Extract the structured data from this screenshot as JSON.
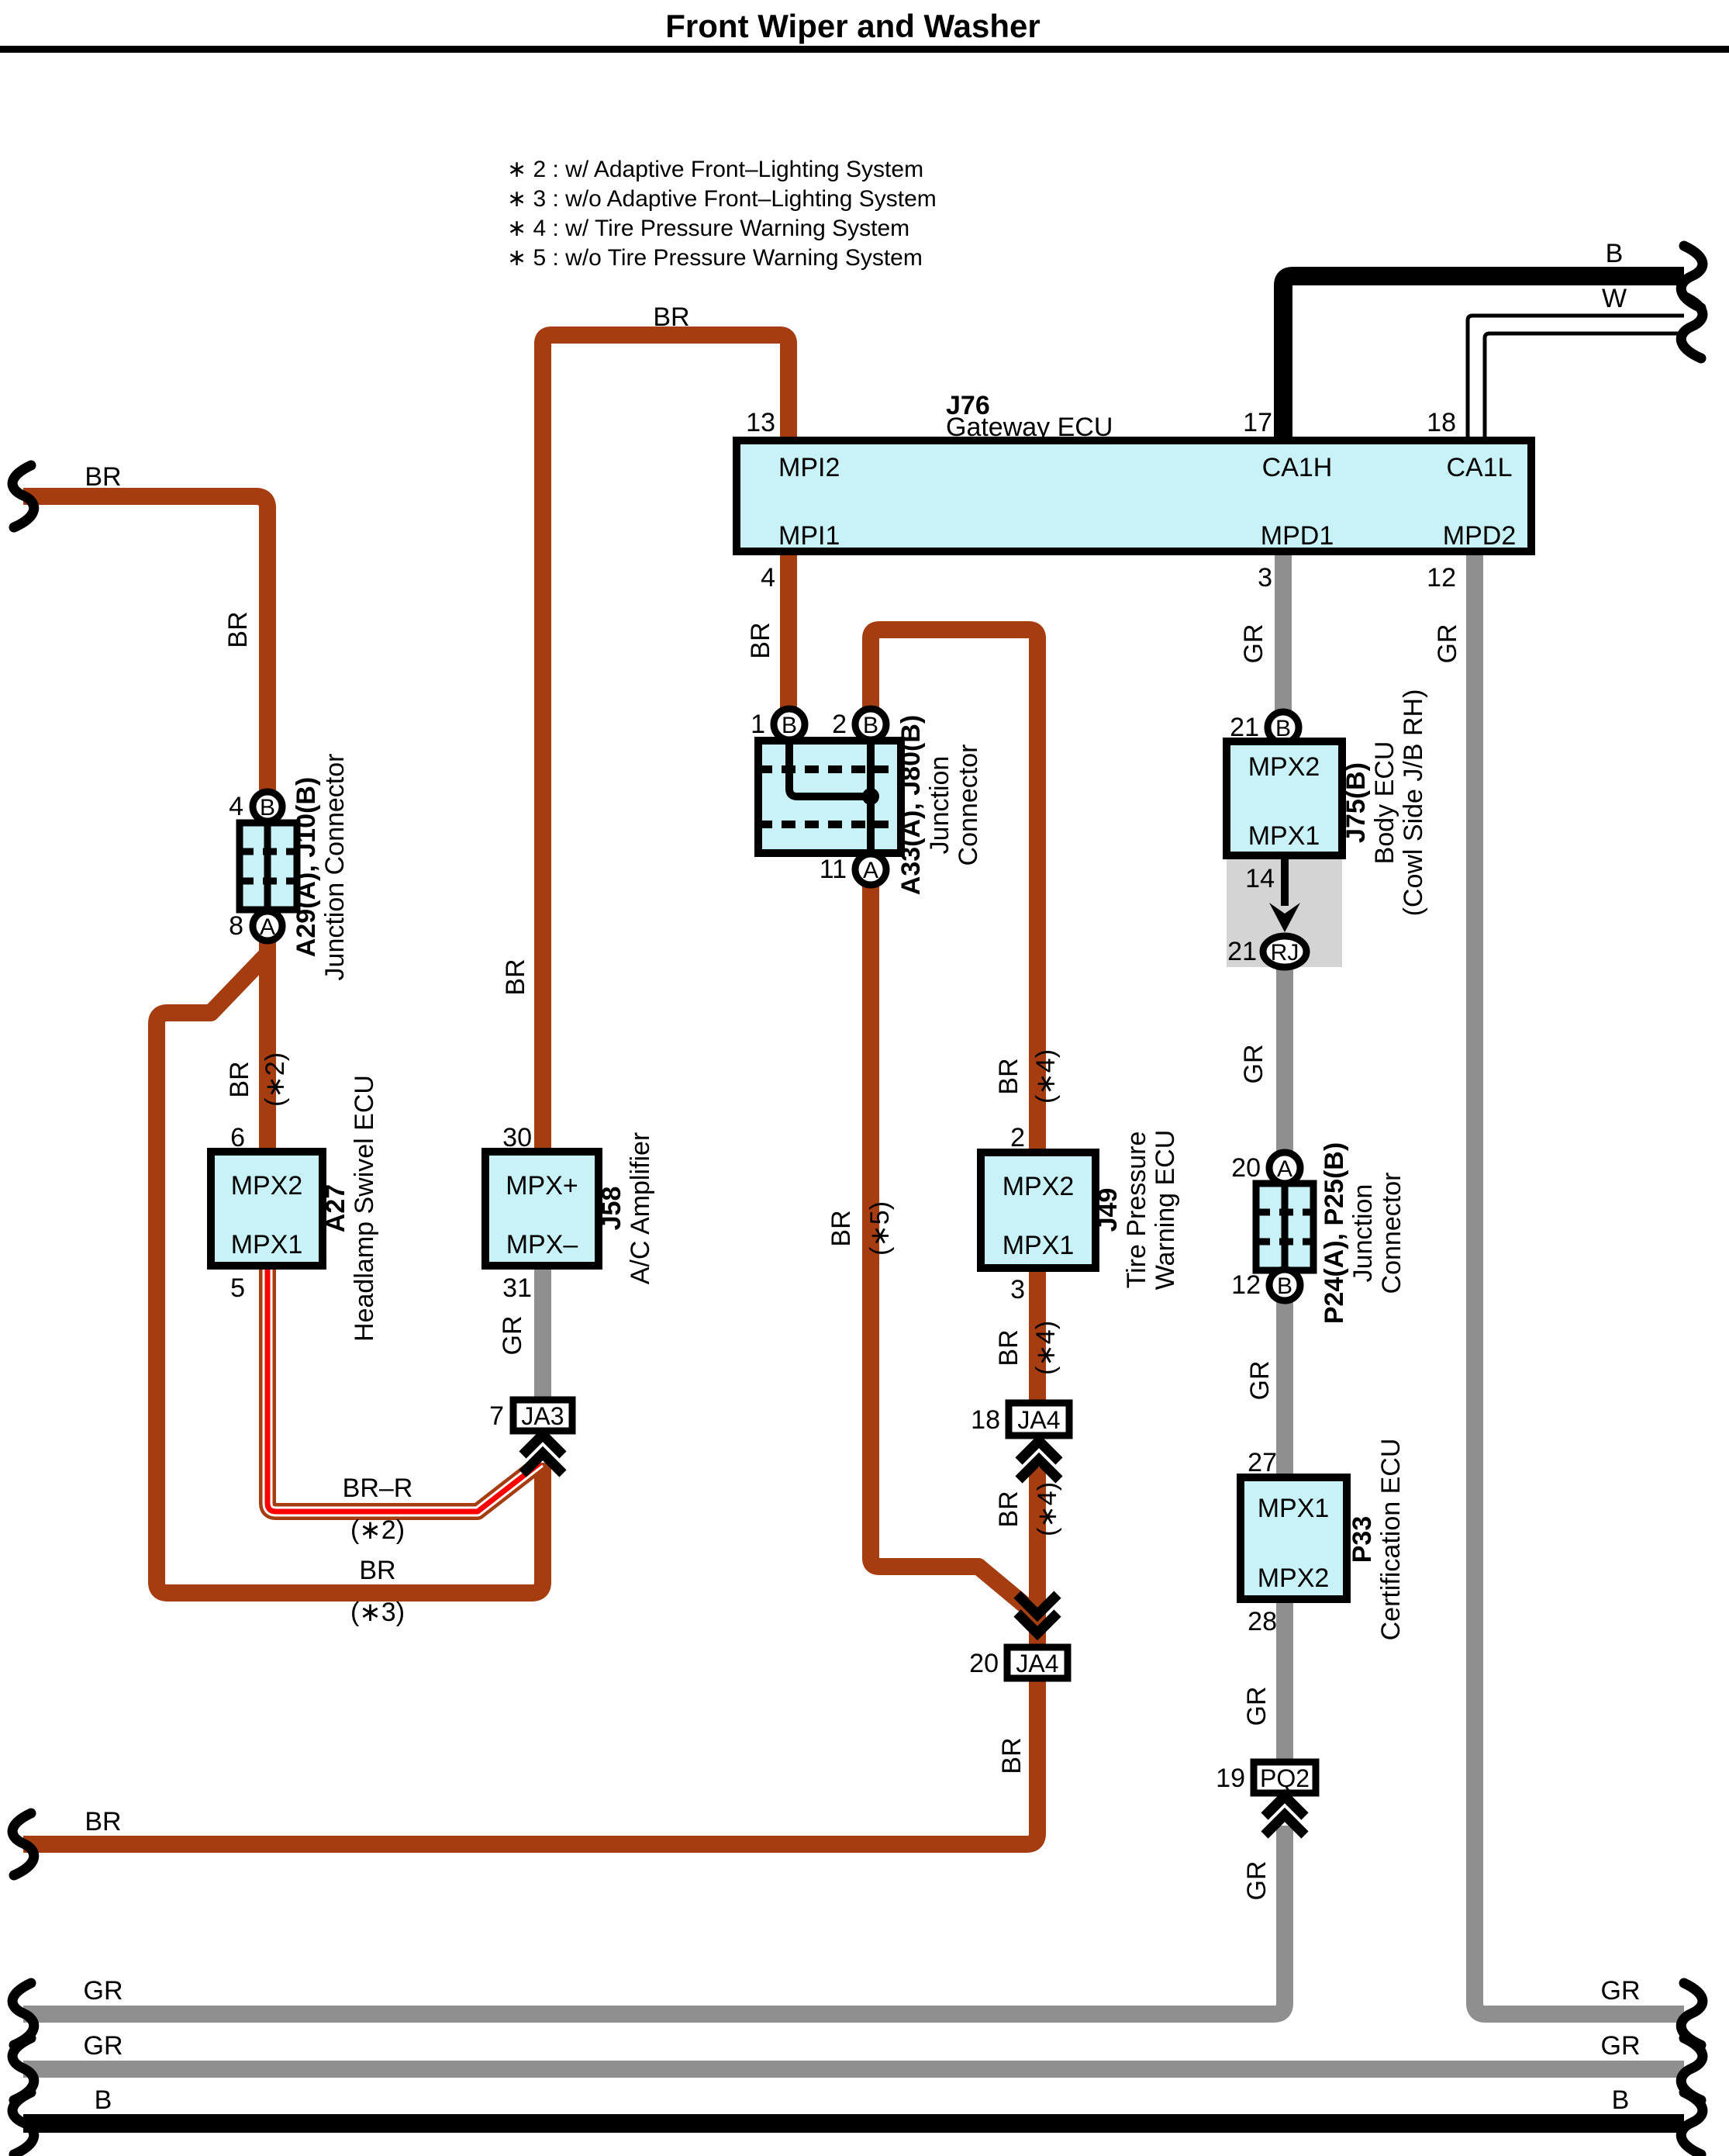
{
  "title": "Front Wiper and Washer",
  "notes": {
    "n2": "∗ 2 : w/ Adaptive Front–Lighting System",
    "n3": "∗ 3 : w/o Adaptive Front–Lighting System",
    "n4": "∗ 4 : w/ Tire Pressure Warning System",
    "n5": "∗ 5 : w/o Tire Pressure Warning System"
  },
  "colors": {
    "wire_brown": "#A63D11",
    "wire_gray": "#8F8F8F",
    "wire_black": "#000000",
    "wire_red_stripe": "#FF0000",
    "component_fill": "#C9F2F8",
    "shade_fill": "#D4D4D4"
  },
  "wire_labels": {
    "br": "BR",
    "gr": "GR",
    "b": "B",
    "w": "W",
    "br_r": "BR–R",
    "s2": "(∗2)",
    "s3": "(∗3)",
    "s4": "(∗4)",
    "s5": "(∗5)"
  },
  "j76": {
    "name": "J76",
    "desc": "Gateway ECU",
    "mpi2": "MPI2",
    "pin_mpi2": "13",
    "mpi1": "MPI1",
    "pin_mpi1": "4",
    "ca1h": "CA1H",
    "pin_ca1h": "17",
    "mpd1": "MPD1",
    "pin_mpd1": "3",
    "ca1l": "CA1L",
    "pin_ca1l": "18",
    "mpd2": "MPD2",
    "pin_mpd2": "12"
  },
  "a29": {
    "name": "A29(A), J10(B)",
    "desc": "Junction Connector",
    "pin_top": "4",
    "top": "B",
    "pin_bottom": "8",
    "bottom": "A"
  },
  "a33": {
    "name": "A33(A), J80(B)",
    "desc1": "Junction",
    "desc2": "Connector",
    "pin1": "1",
    "l1": "B",
    "pin2": "2",
    "l2": "B",
    "pin11": "11",
    "l11": "A"
  },
  "a27": {
    "name": "A27",
    "desc": "Headlamp Swivel ECU",
    "top": "MPX2",
    "bottom": "MPX1",
    "pin_top": "6",
    "pin_bottom": "5"
  },
  "j58": {
    "name": "J58",
    "desc": "A/C Amplifier",
    "top": "MPX+",
    "bottom": "MPX–",
    "pin_top": "30",
    "pin_bottom": "31"
  },
  "j49": {
    "name": "J49",
    "desc1": "Tire Pressure",
    "desc2": "Warning ECU",
    "top": "MPX2",
    "bottom": "MPX1",
    "pin_top": "2",
    "pin_bottom": "3"
  },
  "j75": {
    "name": "J75(B)",
    "desc1": "Body ECU",
    "desc2": "(Cowl Side J/B RH)",
    "pin_b": "21",
    "lb": "B",
    "top": "MPX2",
    "bottom": "MPX1",
    "pin14": "14",
    "pin_rj": "21",
    "rj": "RJ"
  },
  "p24": {
    "name": "P24(A), P25(B)",
    "desc1": "Junction",
    "desc2": "Connector",
    "pin_top": "20",
    "top": "A",
    "pin_bottom": "12",
    "bottom": "B"
  },
  "p33": {
    "name": "P33",
    "desc": "Certification ECU",
    "top": "MPX1",
    "bottom": "MPX2",
    "pin_top": "27",
    "pin_bottom": "28"
  },
  "ja3": {
    "label": "JA3",
    "pin": "7"
  },
  "ja4_18": {
    "label": "JA4",
    "pin": "18"
  },
  "ja4_20": {
    "label": "JA4",
    "pin": "20"
  },
  "pq2": {
    "label": "PQ2",
    "pin": "19"
  }
}
